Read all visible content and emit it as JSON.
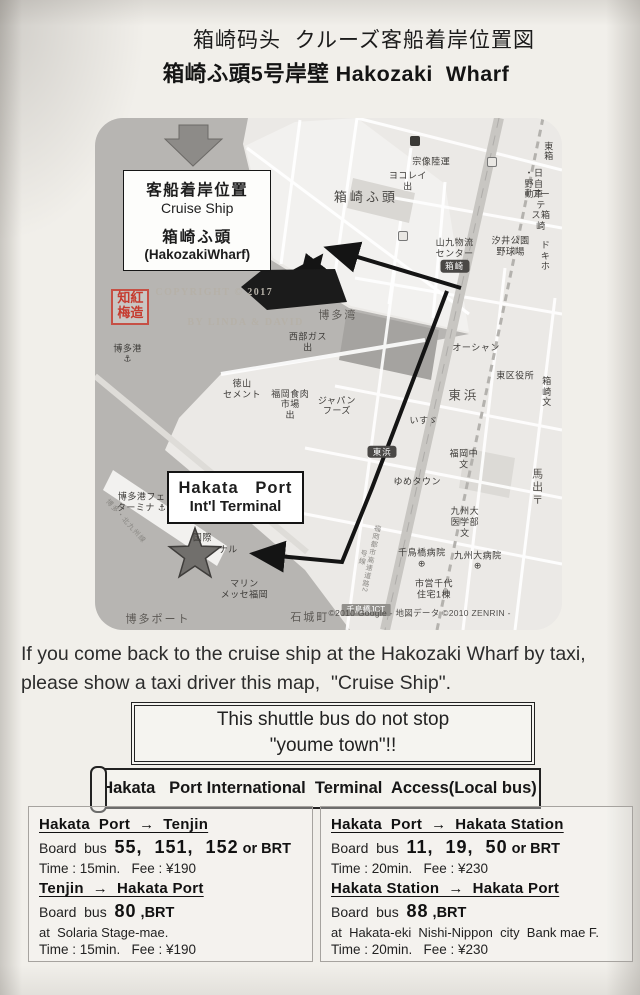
{
  "document": {
    "title_line1": "箱崎码头  クルーズ客船着岸位置図",
    "title_line2": "箱崎ふ頭5号岸壁 Hakozaki  Wharf"
  },
  "map": {
    "cruise_box": {
      "l1": "客船着岸位置",
      "l2": "Cruise Ship",
      "l3": "箱崎ふ頭",
      "l4": "(HakozakiWharf)"
    },
    "terminal_box": {
      "l1": "Hakata   Port",
      "l2": "Int'l Terminal"
    },
    "copyright": {
      "seal": "知紅\n梅造",
      "l1": "COPYRIGHT © 2017",
      "l2": "BY LINDA & DAVID"
    },
    "credit": "©2010 Google - 地図データ ©2010 ZENRIN -",
    "stations": [
      {
        "name": "箱崎"
      },
      {
        "name": "東浜"
      },
      {
        "name": "千鳥橋JCT"
      }
    ],
    "labels": [
      {
        "text": "箱崎ふ頭"
      },
      {
        "text": "宗像陸運"
      },
      {
        "text": "ヨコレイ\n出"
      },
      {
        "text": "・日野自動車"
      },
      {
        "text": "アーテ\nス箱崎"
      },
      {
        "text": "山九物流\nセンター"
      },
      {
        "text": "汐井公園\n野球場"
      },
      {
        "text": "ド\nキホ"
      },
      {
        "text": "博多湾"
      },
      {
        "text": "西部ガス\n出"
      },
      {
        "text": "博多港\n⚓"
      },
      {
        "text": "徳山\nセメント"
      },
      {
        "text": "福岡食肉\n市場\n出"
      },
      {
        "text": "ジャパン\nフーズ"
      },
      {
        "text": "オーシャン"
      },
      {
        "text": "東区役所"
      },
      {
        "text": "箱崎\n文"
      },
      {
        "text": "東浜"
      },
      {
        "text": "いすゞ"
      },
      {
        "text": "福岡中\n文"
      },
      {
        "text": "ゆめタウン"
      },
      {
        "text": "馬出 〒"
      },
      {
        "text": "九州大\n医学部\n文"
      },
      {
        "text": "千鳥橋病院\n⊕"
      },
      {
        "text": "九州大病院\n⊕"
      },
      {
        "text": "市営千代\n住宅1棟"
      },
      {
        "text": "石城町"
      },
      {
        "text": "博多港フェ\nターミナ ⚓"
      },
      {
        "text": "国際"
      },
      {
        "text": "ナル"
      },
      {
        "text": "マリン\nメッセ福岡"
      },
      {
        "text": "博多ポート"
      },
      {
        "text": "東箱"
      },
      {
        "text": "博多・北九州線"
      },
      {
        "text": "福岡都市高速道路2号線"
      }
    ]
  },
  "taxi_note": {
    "line1": "If you come back to the cruise ship at the Hakozaki Wharf by taxi,",
    "line2": "please show a taxi driver this map,  \"Cruise Ship\"."
  },
  "shuttle_note": {
    "line1": "This shuttle bus do not stop",
    "line2": "\"youme town\"!!"
  },
  "access_header": {
    "title": "Hakata   Port International  Terminal  Access(Local bus)"
  },
  "bus_panels": {
    "left": {
      "routes": [
        {
          "header": "Hakata  Port  →  Tenjin",
          "board_label": "Board  bus",
          "buses": "55,  151,  152",
          "bus_suffix": " or BRT",
          "note": "",
          "time": "Time : 15min.   Fee : ¥190"
        },
        {
          "header": "Tenjin  →  Hakata Port",
          "board_label": "Board  bus",
          "buses": "80",
          "bus_suffix": " ,BRT",
          "note": "at  Solaria Stage-mae.",
          "time": "Time : 15min.   Fee : ¥190"
        }
      ]
    },
    "right": {
      "routes": [
        {
          "header": "Hakata  Port  →  Hakata Station",
          "board_label": "Board  bus",
          "buses": "11,  19,  50",
          "bus_suffix": " or BRT",
          "note": "",
          "time": "Time : 20min.   Fee : ¥230"
        },
        {
          "header": "Hakata Station  →  Hakata Port",
          "board_label": "Board  bus",
          "buses": "88",
          "bus_suffix": " ,BRT",
          "note": "at  Hakata-eki  Nishi-Nippon  city  Bank mae F.",
          "time": "Time : 20min.   Fee : ¥230"
        }
      ]
    }
  },
  "colors": {
    "ink": "#1d1d1d",
    "water": "#b7b5b2",
    "route": "#141414",
    "seal_red": "#c63b2f"
  }
}
